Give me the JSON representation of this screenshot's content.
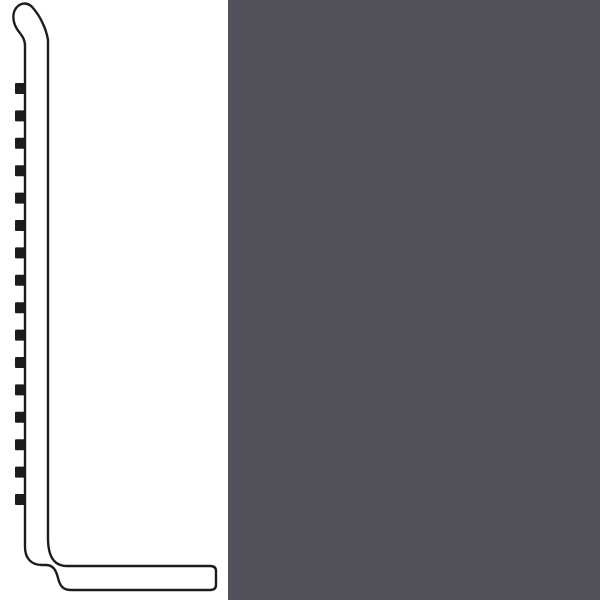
{
  "page": {
    "background_color": "#ffffff",
    "width": 600,
    "height": 600
  },
  "diagram": {
    "label": "wall-base-molding-profile-cross-section",
    "stroke_color": "#1c1c1e",
    "stroke_width": 2.4,
    "fill_color": "#ffffff",
    "outline_path": "M 48 40 L 48 538 C 48 555 53 566 67 566 L 210 566 Q 216 566 216 571 L 216 585 Q 216 590 210 590 L 71 590 C 63 590 60 586 58 578 C 56 570 53 565 46 565 L 42 565 C 31 565 25 558 25 547 L 25 46 C 25 38 21 35 17 29 C 12 21 12 11 18 6 C 23 2 29 3 33 8 C 40 16 46 28 48 40 Z",
    "teeth": {
      "count": 16,
      "x": 15,
      "width": 11,
      "height": 11,
      "first_y": 83,
      "pitch": 27.4,
      "fill": "#1c1c1e",
      "corner_radius": 1
    }
  },
  "swatch": {
    "label": "color-swatch-panel",
    "color": "#53515C",
    "x": 228,
    "y": 0,
    "width": 372,
    "height": 600
  }
}
